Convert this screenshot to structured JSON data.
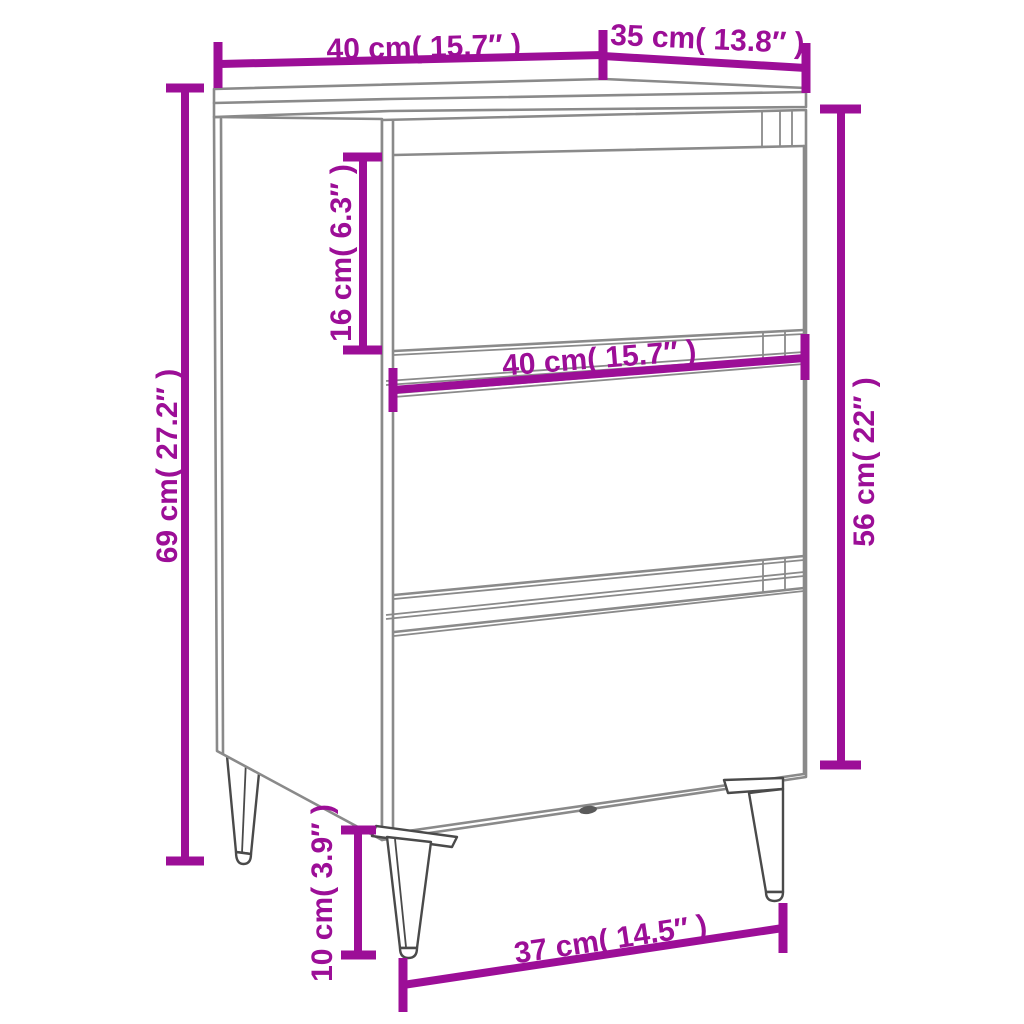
{
  "diagram": {
    "title": "bedside-cabinet-dimension-diagram",
    "background_color": "#ffffff",
    "accent_color": "#9C0E97",
    "outline_color": "#8A8A8A",
    "leg_outline_color": "#4A4A4A",
    "unit_primary": "cm",
    "unit_secondary": "inch",
    "dimensions": [
      {
        "id": "top-width",
        "label": "40 cm( 15.7″ )",
        "cm": 40,
        "inch": 15.7,
        "measures": "top panel width"
      },
      {
        "id": "top-depth",
        "label": "35 cm( 13.8″ )",
        "cm": 35,
        "inch": 13.8,
        "measures": "top panel depth"
      },
      {
        "id": "overall-height",
        "label": "69 cm( 27.2″ )",
        "cm": 69,
        "inch": 27.2,
        "measures": "overall height"
      },
      {
        "id": "drawer-height",
        "label": "16 cm( 6.3″ )",
        "cm": 16,
        "inch": 6.3,
        "measures": "drawer front height"
      },
      {
        "id": "front-width",
        "label": "40 cm( 15.7″ )",
        "cm": 40,
        "inch": 15.7,
        "measures": "drawer front width"
      },
      {
        "id": "body-height",
        "label": "56 cm( 22″ )",
        "cm": 56,
        "inch": 22,
        "measures": "cabinet body height"
      },
      {
        "id": "leg-height",
        "label": "10 cm( 3.9″ )",
        "cm": 10,
        "inch": 3.9,
        "measures": "leg height"
      },
      {
        "id": "bottom-depth",
        "label": "37 cm( 14.5″ )",
        "cm": 37,
        "inch": 14.5,
        "measures": "bottom depth between legs"
      }
    ]
  }
}
